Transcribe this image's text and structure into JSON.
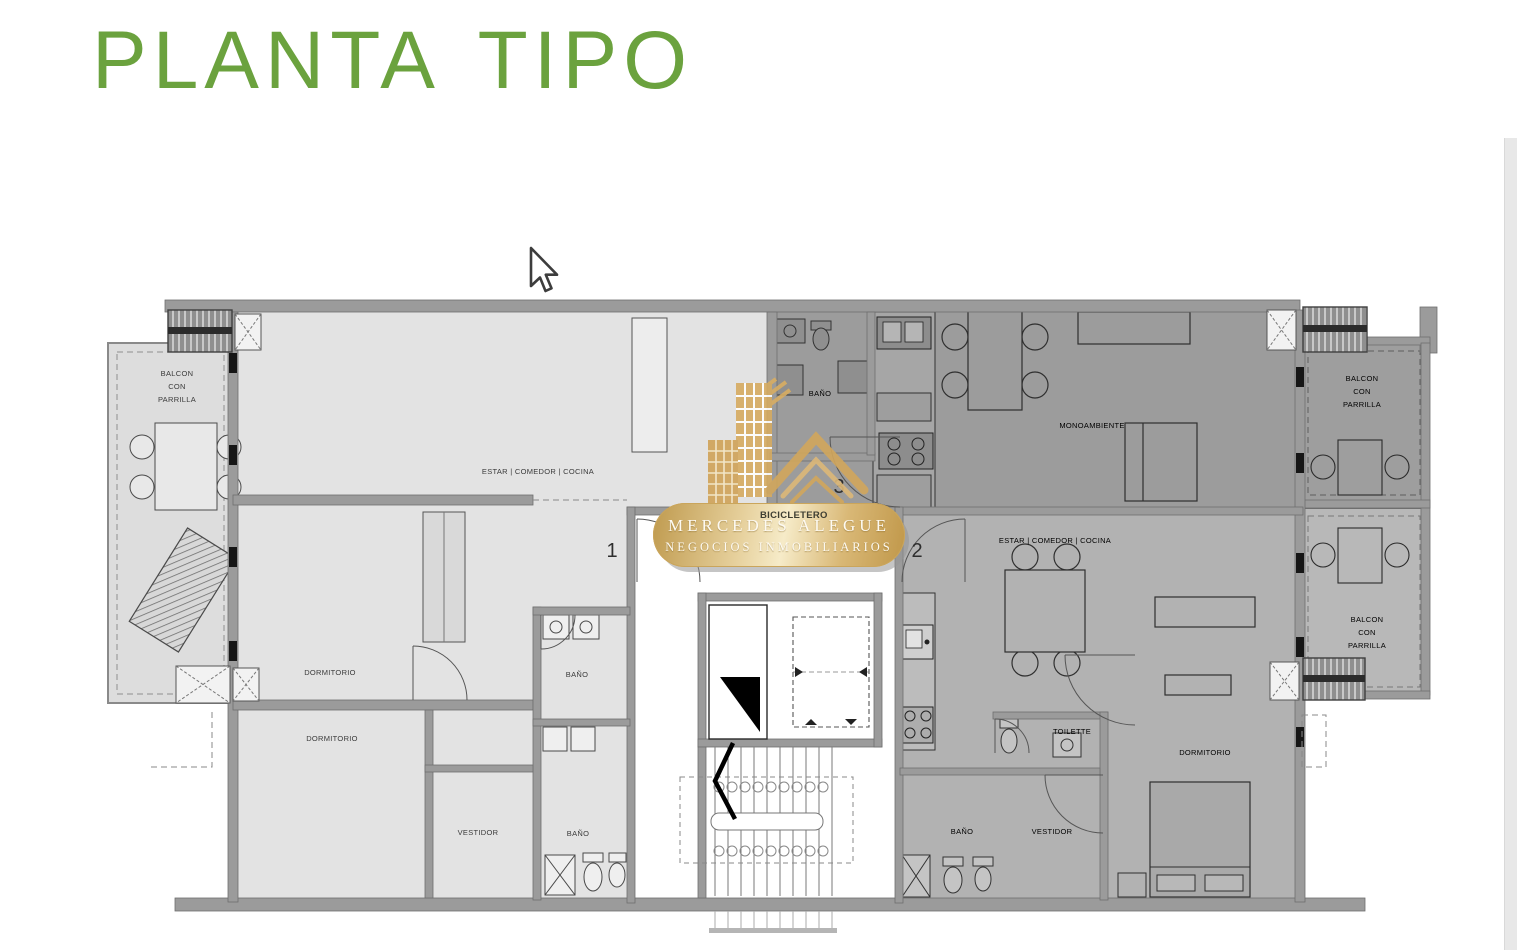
{
  "title": {
    "text": "PLANTA TIPO",
    "color": "#6ba23e"
  },
  "watermark": {
    "line1": "MERCEDES ALEGUE",
    "line2": "NEGOCIOS INMOBILIARIOS",
    "gold": "#d2a75c",
    "text_color": "#fdfaf2"
  },
  "plan": {
    "unit_numbers": {
      "u1": "1",
      "u2": "2",
      "u3": "3"
    },
    "rooms": {
      "balcon_l1": "BALCON",
      "balcon_l2": "CON",
      "balcon_l3": "PARRILLA",
      "estar_comedor_cocina": "ESTAR | COMEDOR | COCINA",
      "dormitorio": "DORMITORIO",
      "bano": "BAÑO",
      "vestidor": "VESTIDOR",
      "toilette": "TOILETTE",
      "monoambiente": "MONOAMBIENTE",
      "bicicletero": "BICICLETERO"
    },
    "colors": {
      "wall": "#9b9b9b",
      "unit1_fill": "#e3e3e3",
      "unit2_fill": "#b2b2b2",
      "unit3_fill": "#9c9c9c",
      "core_fill": "#ffffff",
      "balcony_left_fill": "#dddddd",
      "balcony_right_top_fill": "#9e9e9e",
      "balcony_right_bottom_fill": "#b8b8b8"
    }
  }
}
